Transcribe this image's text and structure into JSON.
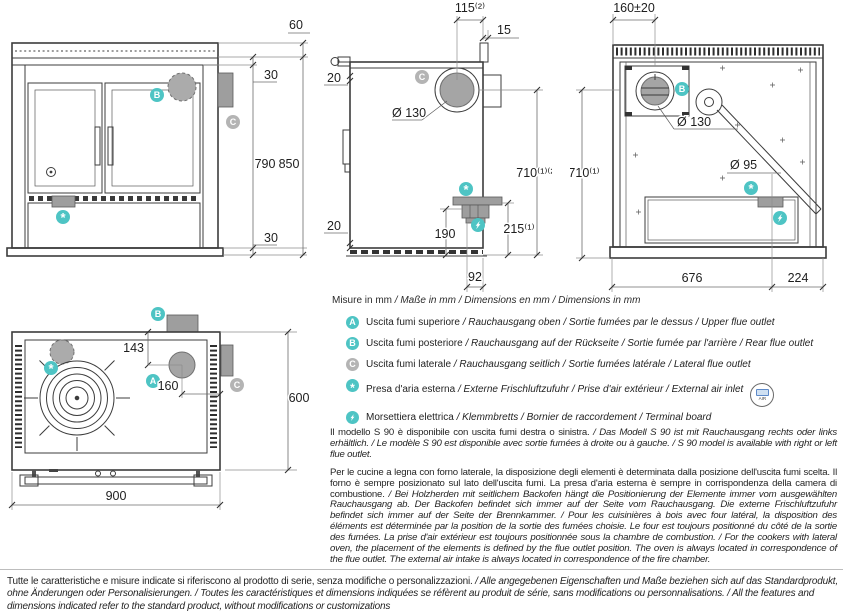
{
  "colors": {
    "teal": "#4ec4c4",
    "badge_gray": "#b4b4b4",
    "fill_gray": "#a5a5a5",
    "line": "#3c3c3c"
  },
  "badges": {
    "a": "A",
    "b": "B",
    "c": "C",
    "air": "*",
    "air_medallion_label": "AIR"
  },
  "drawings": {
    "front": {
      "dims": {
        "rail_height": "60",
        "top_gap": "30",
        "body_height": "790",
        "total_height": "850",
        "plinth_height": "30"
      }
    },
    "side": {
      "dims": {
        "flue_offset": "115⁽²⁾",
        "splash_depth": "15",
        "top_inset": "20",
        "bottom_inset": "20",
        "flue_diameter": "Ø 130",
        "flue_height": "710⁽¹⁾⁽²⁾",
        "air_inlet_height": "215⁽¹⁾",
        "air_flange_height": "190",
        "air_offset": "92"
      }
    },
    "back": {
      "dims": {
        "flue_offset": "160±20",
        "flue_diameter": "Ø 130",
        "air_pipe_diameter": "Ø 95",
        "flue_height": "710⁽¹⁾",
        "width_left": "676",
        "width_right": "224"
      }
    },
    "top": {
      "dims": {
        "flue_depth": "143",
        "flue_side_offset": "160",
        "depth": "600",
        "width": "900"
      }
    }
  },
  "legend": {
    "note_it": "Misure in mm",
    "note_rest": " / Maße in mm / Dimensions en mm / Dimensions in mm",
    "items": [
      {
        "badge_char": "A",
        "color": "teal",
        "text_it": "Uscita fumi superiore",
        "text_rest": " / Rauchausgang oben  / Sortie fumées par le dessus / Upper flue outlet"
      },
      {
        "badge_char": "B",
        "color": "teal",
        "text_it": "Uscita fumi posteriore",
        "text_rest": " / Rauchausgang auf der Rückseite / Sortie fumée par l'arrière / Rear flue outlet"
      },
      {
        "badge_char": "C",
        "color": "gray",
        "text_it": "Uscita fumi laterale",
        "text_rest": " / Rauchausgang seitlich  / Sortie fumées latérale / Lateral flue outlet"
      },
      {
        "badge_char": "*",
        "icon": "asterisk-icon",
        "color": "teal",
        "text_it": "Presa d'aria esterna",
        "text_rest": " / Externe Frischluftzufuhr / Prise d'air extérieur / External air inlet"
      },
      {
        "badge_char": "",
        "icon": "lightning-icon",
        "color": "teal",
        "text_it": "Morsettiera elettrica",
        "text_rest": " / Klemmbretts / Bornier de raccordement / Terminal board"
      }
    ]
  },
  "paragraphs": [
    {
      "text_it": "Il modello S 90 è disponibile con uscita fumi destra o sinistra.",
      "text_rest": " / Das Modell S 90 ist mit Rauchausgang rechts oder links erhältlich. / Le modèle S 90 est disponible avec sortie fumées à droite ou à gauche. / S 90 model is available with right or left flue outlet."
    },
    {
      "text_it": "Per le cucine a legna con forno laterale, la disposizione degli elementi è determinata dalla posizione dell'uscita fumi scelta. Il forno è sempre posizionato sul lato dell'uscita fumi. La presa d'aria esterna è sempre in corrispondenza della camera di combustione.",
      "text_rest": " / Bei Holzherden mit seitlichem Backofen hängt die Positionierung der Elemente immer vom ausgewählten Rauchausgang ab. Der Backofen befindet sich immer auf der Seite vom Rauchausgang. Die externe Frischluftzufuhr befindet sich immer auf der Seite der Brennkammer. / Pour les cuisinières à bois avec four latéral, la disposition des éléments est déterminée par la position de la sortie des fumées choisie. Le four est toujours positionné du côté de la sortie des fumées. La prise d'air extérieur est toujours positionnée sous la chambre de combustion. / For the cookers with lateral oven, the placement of the elements is defined by the flue outlet position. The oven is always located in correspondence of the flue outlet. The external air intake is always located in correspondence of the fire chamber."
    }
  ],
  "footer": {
    "text_it": "Tutte le caratteristiche e misure indicate si riferiscono al prodotto di serie, senza modifiche o personalizzazioni.",
    "text_rest": " / Alle angegebenen Eigenschaften und Maße beziehen sich auf das Standardprodukt, ohne Änderungen oder Personalisierungen. / Toutes les caractéristiques et dimensions indiquées se réfèrent au produit de série, sans modifications ou personnalisations. / All the features and dimensions indicated refer to the standard product, without modifications or customizations"
  }
}
